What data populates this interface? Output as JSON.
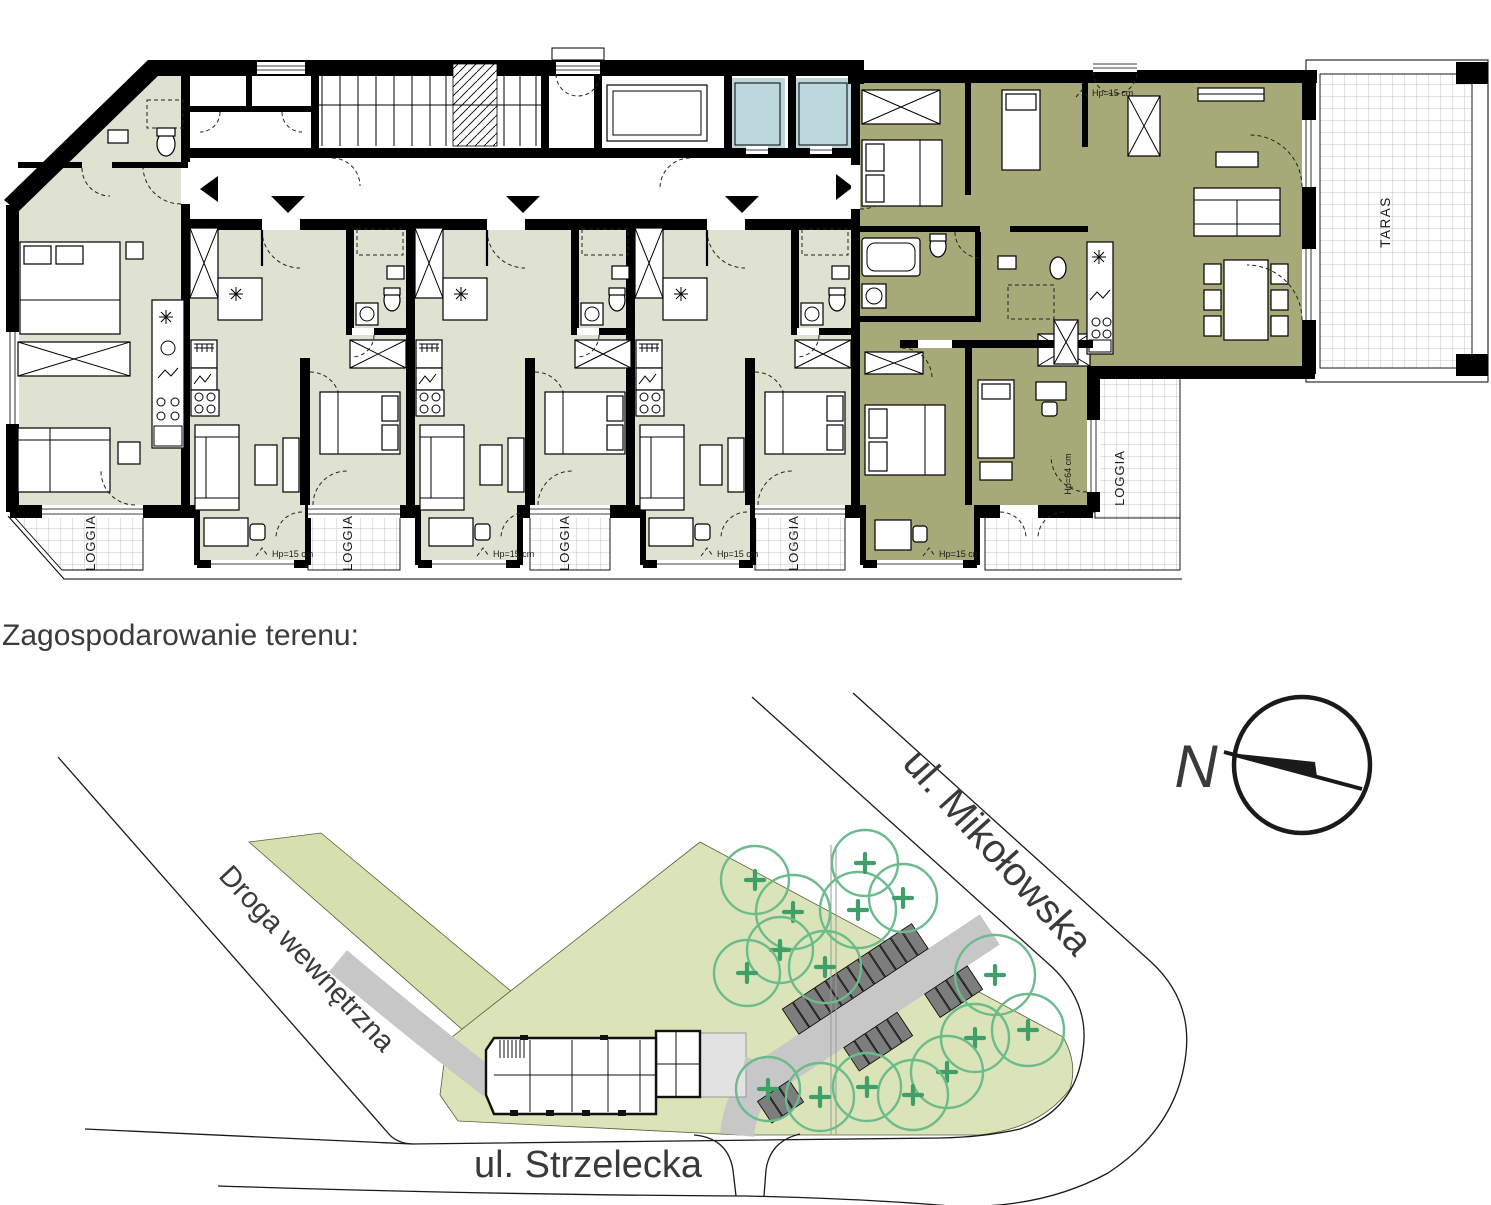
{
  "header": {
    "title": "Zagospodarowanie terenu:"
  },
  "floor_plan": {
    "labels": {
      "loggia": [
        "LOGGIA",
        "LOGGIA",
        "LOGGIA",
        "LOGGIA",
        "LOGGIA"
      ],
      "taras": "TARAS",
      "hp_15": "Hp=15 cm",
      "hp_64": "Hp=64 cm"
    },
    "colors": {
      "apartment_fill": "#dfe2d0",
      "selected_fill": "#a5aa78",
      "elevator_fill": "#bcd8dc",
      "wall": "#000000",
      "grid_line": "#b5b5b5"
    }
  },
  "site_plan": {
    "north_label": "N",
    "streets": {
      "mikolowska": "ul. Mikołowska",
      "strzelecka": "ul. Strzelecka",
      "internal": "Droga wewnętrzna"
    },
    "colors": {
      "site_fill": "#dbe4b8",
      "strip_fill": "#d6e0af",
      "tree_stroke": "#6cbb8c",
      "tree_plus": "#3f9f68",
      "road_fill": "#c7c7c7",
      "parking_fill": "#7d7d7d",
      "plaza_fill": "#e2e2e2",
      "text": "#3a3a3a"
    }
  }
}
